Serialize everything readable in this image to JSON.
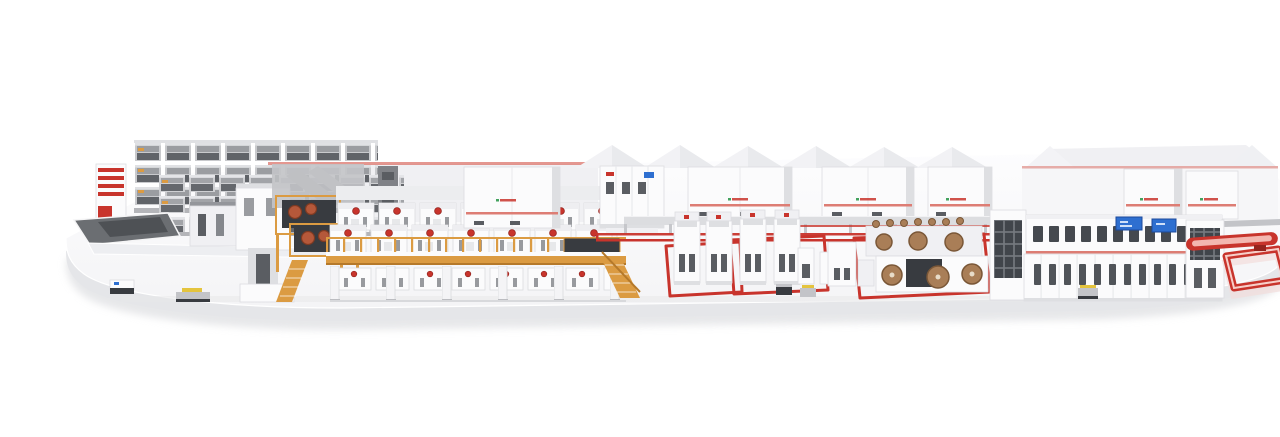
{
  "meta": {
    "description": "Photorealistic 3D render of a complete corrugated-board production line standing on a rounded white platform, shown in slight front perspective with white and red machinery, an amber wet-end bridge, paper reel stands, red AGV floor guide tracks and a long dry-end machine with blue HMI screens.",
    "canvas": {
      "width": 1280,
      "height": 405
    }
  },
  "palette": {
    "background": "#ffffff",
    "platform-top": "#f4f4f6",
    "platform-top-hi": "#fdfdfe",
    "platform-face": "#e5e6e9",
    "platform-shadow": "#d3d4d8",
    "machine-white": "#fbfbfc",
    "machine-light": "#f0f0f3",
    "machine-mid": "#dedfe2",
    "machine-gray": "#c3c4c8",
    "steel": "#94969b",
    "slot-dark": "#5a5d62",
    "panel-dark": "#383b40",
    "accent-red": "#c8342c",
    "accent-red-dark": "#95241e",
    "stripe-red": "#dd7d74",
    "amber": "#db9b42",
    "amber-dark": "#b5792a",
    "roll-brown": "#a97e57",
    "roll-brown-dark": "#7a5737",
    "facer-roll": "#b5583a",
    "hmi-blue": "#2e6fd0",
    "hmi-blue-dark": "#1c4a9c",
    "logo-green": "#43a25e",
    "pallet-yellow": "#e4c43e",
    "floor-shadow": "#e7e8ea"
  },
  "scene": {
    "sections": [
      {
        "id": "factory-backdrop",
        "label": "factory buildings backdrop"
      },
      {
        "id": "reel-storage-rack",
        "label": "automated reel storage rack"
      },
      {
        "id": "infeed-station",
        "label": "infeed station with tables and lift"
      },
      {
        "id": "wet-end-bridge",
        "label": "elevated wet-end corrugator bridge"
      },
      {
        "id": "single-facer-units",
        "label": "single facer units with rolls"
      },
      {
        "id": "electrical-cabinet-row",
        "label": "row of white electrical cabinets"
      },
      {
        "id": "transport-conveyor",
        "label": "overhead transport conveyor"
      },
      {
        "id": "floor-guide-lines",
        "label": "red AGV floor guide lines"
      },
      {
        "id": "splicer-stations",
        "label": "splicer towers inside red floor tracks"
      },
      {
        "id": "reel-stands",
        "label": "mill reel stands with brown paper rolls"
      },
      {
        "id": "dry-end-machine",
        "label": "dry-end machine with blue HMI screens"
      },
      {
        "id": "waste-conveyor",
        "label": "red conveyor bar and floor loop"
      },
      {
        "id": "agv-carts",
        "label": "AGV transport carts"
      }
    ]
  }
}
